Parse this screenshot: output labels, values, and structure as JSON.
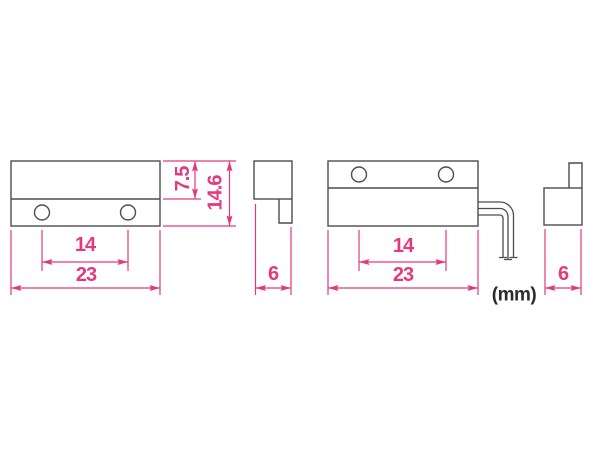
{
  "diagram": {
    "unit_note": "(mm)",
    "colors": {
      "dimension": "#E4397D",
      "outline": "#4D4D4D",
      "unit_text": "#2B2B2B",
      "background": "#FFFFFF"
    },
    "magnet": {
      "front": {
        "width": "23",
        "hole_spacing": "14",
        "top_section_height": "7.5",
        "height": "14.6"
      },
      "side": {
        "depth": "6"
      }
    },
    "switch": {
      "front": {
        "width": "23",
        "hole_spacing": "14"
      },
      "side": {
        "depth": "6"
      }
    }
  }
}
